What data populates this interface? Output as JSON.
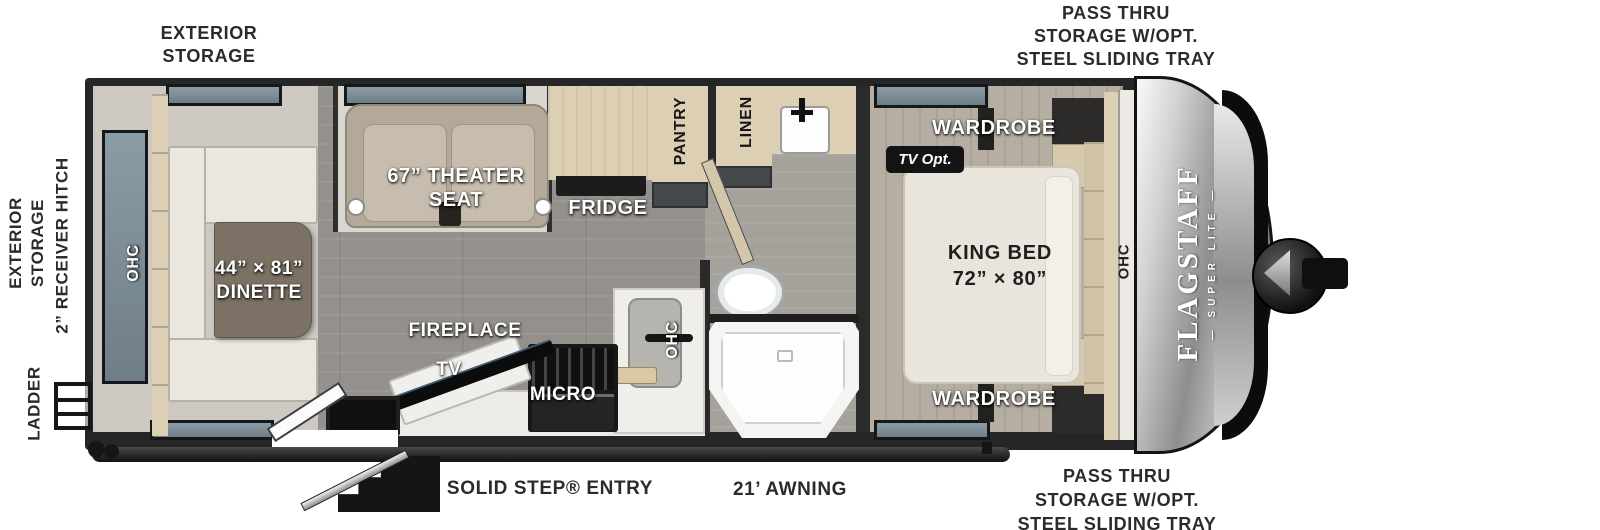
{
  "colors": {
    "wall": "#262626",
    "floor_main": "#94908b",
    "floor_slide": "#cdc9c2",
    "floor_bedroom": "#b6aea2",
    "cabinet_tan": "#dccfb4",
    "bench_cream": "#ebe7de",
    "table_brown": "#7b7265",
    "label_dark": "#2b2b2b",
    "cap_silver": "#b9b9b9"
  },
  "exterior": {
    "top_left": {
      "line1": "EXTERIOR",
      "line2": "STORAGE"
    },
    "top_right": {
      "line1": "PASS THRU",
      "line2": "STORAGE W/OPT.",
      "line3": "STEEL SLIDING TRAY"
    },
    "left_storage": {
      "line1": "EXTERIOR",
      "line2": "STORAGE"
    },
    "receiver_hitch": "2” RECEIVER HITCH",
    "ladder": "LADDER",
    "solid_step": "SOLID STEP® ENTRY",
    "awning": "21’ AWNING",
    "bottom_right": {
      "line1": "PASS THRU",
      "line2": "STORAGE W/OPT.",
      "line3": "STEEL SLIDING TRAY"
    }
  },
  "interior": {
    "dinette": {
      "line1": "44” × 81”",
      "line2": "DINETTE"
    },
    "theater": {
      "line1": "67” THEATER",
      "line2": "SEAT"
    },
    "fridge": "FRIDGE",
    "pantry": "PANTRY",
    "linen": "LINEN",
    "fireplace": "FIREPLACE",
    "tv": "TV",
    "micro": "MICRO",
    "ohc_rear": "OHC",
    "ohc_kitchen": "OHC",
    "ohc_bedroom": "OHC",
    "king_bed": {
      "line1": "KING BED",
      "line2": "72” × 80”"
    },
    "wardrobe_top": "WARDROBE",
    "wardrobe_bottom": "WARDROBE",
    "tv_opt": "TV Opt."
  },
  "brand": {
    "name": "FLAGSTAFF",
    "sub": "— SUPER LITE —"
  }
}
